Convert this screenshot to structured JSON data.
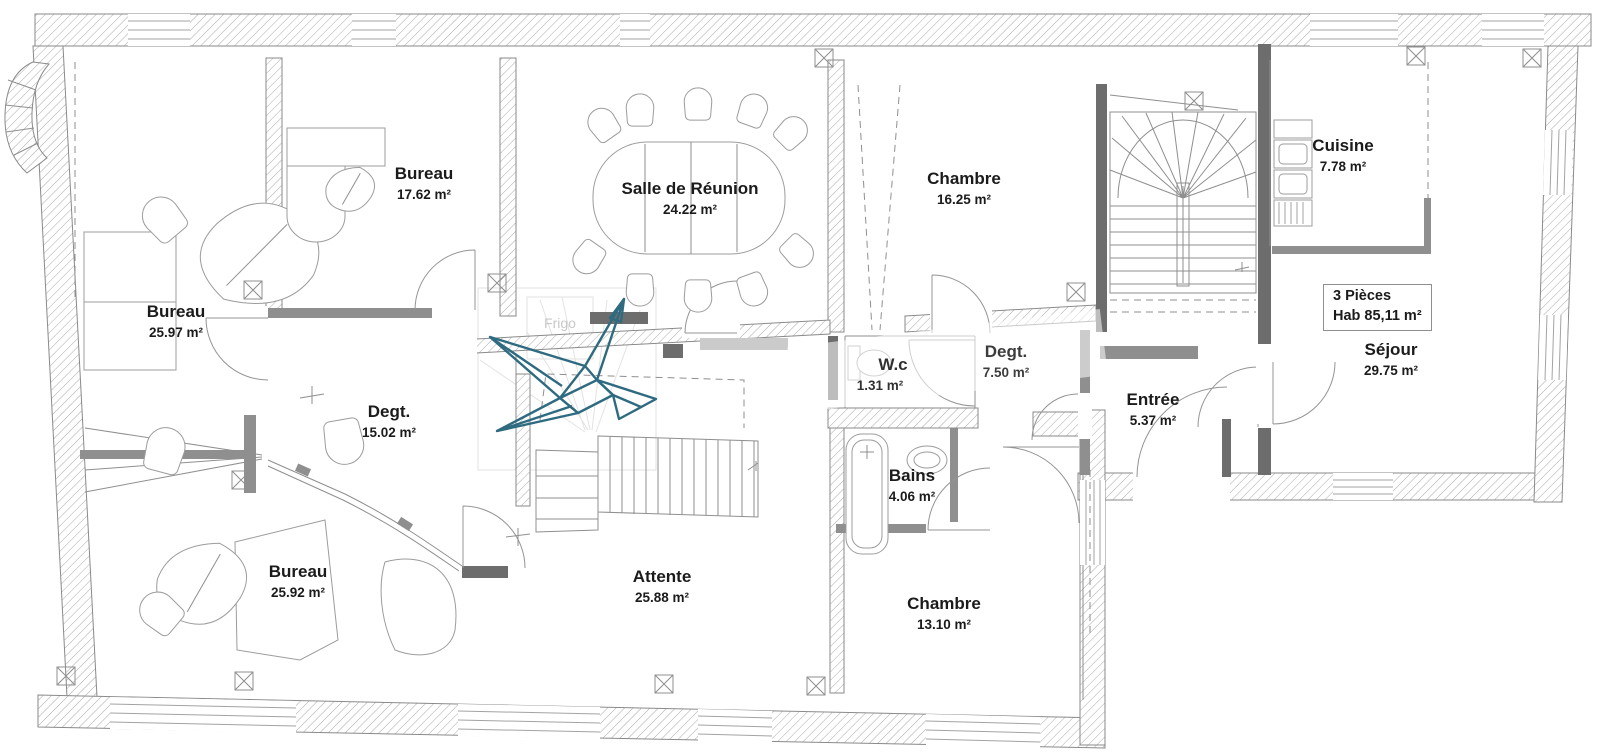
{
  "plan": {
    "rooms": [
      {
        "name": "Bureau",
        "area": "25.97 m²"
      },
      {
        "name": "Bureau",
        "area": "17.62 m²"
      },
      {
        "name": "Salle de Réunion",
        "area": "24.22 m²"
      },
      {
        "name": "Chambre",
        "area": "16.25 m²"
      },
      {
        "name": "Cuisine",
        "area": "7.78 m²"
      },
      {
        "name": "Séjour",
        "area": "29.75 m²"
      },
      {
        "name": "Entrée",
        "area": "5.37 m²"
      },
      {
        "name": "Degt.",
        "area": "7.50 m²"
      },
      {
        "name": "W.c",
        "area": "1.31 m²"
      },
      {
        "name": "Bains",
        "area": "4.06 m²"
      },
      {
        "name": "Chambre",
        "area": "13.10 m²"
      },
      {
        "name": "Attente",
        "area": "25.88 m²"
      },
      {
        "name": "Degt.",
        "area": "15.02 m²"
      },
      {
        "name": "Bureau",
        "area": "25.92 m²"
      }
    ],
    "summary_box": {
      "line1": "3 Pièces",
      "line2": "Hab  85,11 m²"
    },
    "appliance_label": "Frigo",
    "colors": {
      "crane_teal": "#2e6b80"
    }
  }
}
